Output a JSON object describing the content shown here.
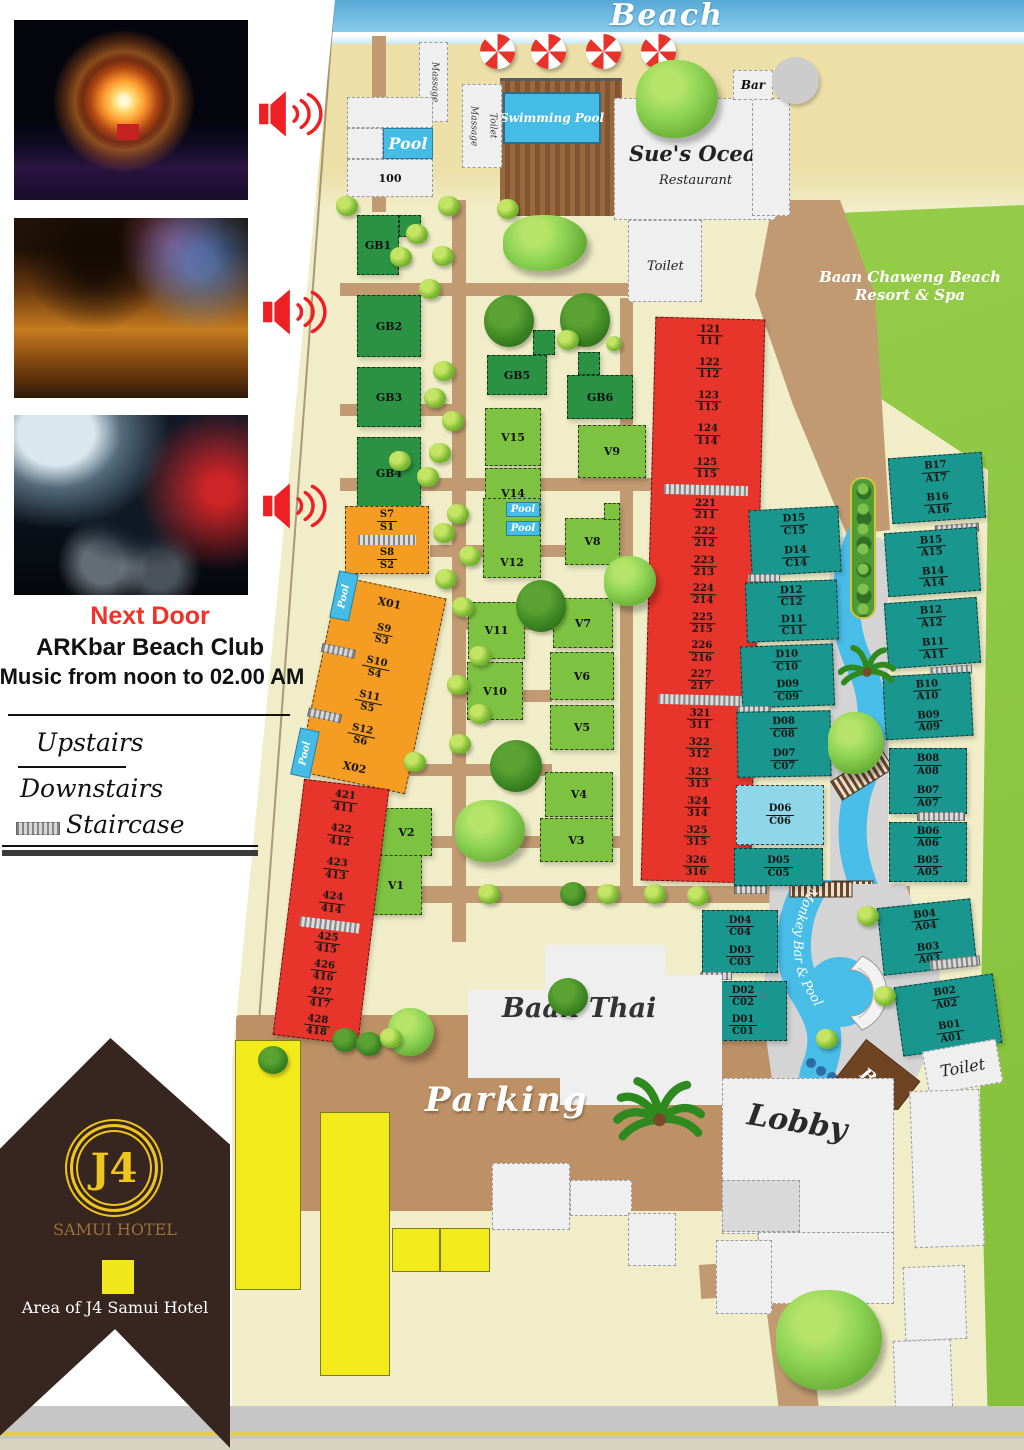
{
  "sidebar": {
    "next_door": "Next Door",
    "club_name": "ARKbar Beach Club",
    "music_hours": "Music from noon to 02.00 AM",
    "legend_upstairs": "Upstairs",
    "legend_downstairs": "Downstairs",
    "legend_staircase": "Staircase",
    "brand_mark": "J4",
    "brand_name": "SAMUI HOTEL",
    "area_label": "Area of J4 Samui Hotel",
    "accent_red": "#f03228",
    "brand_gold": "#eec51d",
    "area_swatch": "#f0e81c"
  },
  "map": {
    "beach": "Beach",
    "massage": "Massage",
    "massage_toilet": "Toilet",
    "pool": "Pool",
    "house_100": "100",
    "swimming_pool": "Swimming Pool",
    "restaurant_name": "Sue's Ocean",
    "restaurant_word": "Restaurant",
    "restaurant_toilet": "Toilet",
    "beach_bar": "Bar",
    "neighbor_line1": "Baan Chaweng Beach",
    "neighbor_line2": "Resort & Spa",
    "baan_thai": "Baan Thai",
    "parking": "Parking",
    "lobby": "Lobby",
    "monkey_pool": "Monkey Bar & Pool",
    "pool_bar": "Bar",
    "lobby_toilet": "Toilet",
    "gb": {
      "gb1": "GB1",
      "gb2": "GB2",
      "gb3": "GB3",
      "gb4": "GB4",
      "gb5": "GB5",
      "gb6": "GB6"
    },
    "v": {
      "v1": "V1",
      "v2": "V2",
      "v3": "V3",
      "v4": "V4",
      "v5": "V5",
      "v6": "V6",
      "v7": "V7",
      "v8": "V8",
      "v9": "V9",
      "v10": "V10",
      "v11": "V11",
      "v12": "V12",
      "v14": "V14",
      "v15": "V15"
    },
    "x": {
      "x01": "X01",
      "x02": "X02"
    },
    "colors": {
      "red": "#e8352b",
      "teal": "#19968e",
      "orange": "#f59d22",
      "light_green": "#7ec242",
      "dark_green": "#2b9143",
      "light_blue": "#8ed6e8",
      "pool_blue": "#45bce6",
      "grass": "#8bc53f",
      "path": "#c19a72",
      "yellow": "#f2ea1b"
    }
  },
  "rooms": {
    "east": [
      [
        [
          "121",
          "111"
        ],
        [
          "122",
          "112"
        ],
        [
          "123",
          "113"
        ],
        [
          "124",
          "114"
        ],
        [
          "125",
          "115"
        ]
      ],
      [
        [
          "221",
          "211"
        ],
        [
          "222",
          "212"
        ],
        [
          "223",
          "213"
        ],
        [
          "224",
          "214"
        ],
        [
          "225",
          "215"
        ],
        [
          "226",
          "216"
        ],
        [
          "227",
          "217"
        ]
      ],
      [
        [
          "321",
          "311"
        ],
        [
          "322",
          "312"
        ],
        [
          "323",
          "313"
        ],
        [
          "324",
          "314"
        ],
        [
          "325",
          "315"
        ],
        [
          "326",
          "316"
        ]
      ]
    ],
    "west": [
      [
        [
          "421",
          "411"
        ],
        [
          "422",
          "412"
        ],
        [
          "423",
          "413"
        ],
        [
          "424",
          "414"
        ]
      ],
      [
        [
          "425",
          "415"
        ],
        [
          "426",
          "416"
        ],
        [
          "427",
          "417"
        ],
        [
          "428",
          "418"
        ]
      ]
    ],
    "s_top_a": [
      [
        "S7",
        "S1"
      ]
    ],
    "s_top_b": [
      [
        "S8",
        "S2"
      ]
    ],
    "s_main": [
      [
        "S9",
        "S3"
      ],
      [
        "S10",
        "S4"
      ],
      [
        "S11",
        "S5"
      ],
      [
        "S12",
        "S6"
      ]
    ],
    "dc": [
      [
        [
          "D15",
          "C15"
        ],
        [
          "D14",
          "C14"
        ]
      ],
      [
        [
          "D12",
          "C12"
        ],
        [
          "D11",
          "C11"
        ]
      ],
      [
        [
          "D10",
          "C10"
        ],
        [
          "D09",
          "C09"
        ]
      ],
      [
        [
          "D08",
          "C08"
        ],
        [
          "D07",
          "C07"
        ]
      ]
    ],
    "dc_blue": [
      [
        "D06",
        "C06"
      ]
    ],
    "dc_05": [
      [
        "D05",
        "C05"
      ]
    ],
    "dc_low": [
      [
        [
          "D04",
          "C04"
        ],
        [
          "D03",
          "C03"
        ]
      ],
      [
        [
          "D02",
          "C02"
        ],
        [
          "D01",
          "C01"
        ]
      ]
    ],
    "ba": [
      [
        [
          "B17",
          "A17"
        ],
        [
          "B16",
          "A16"
        ]
      ],
      [
        [
          "B15",
          "A15"
        ],
        [
          "B14",
          "A14"
        ]
      ],
      [
        [
          "B12",
          "A12"
        ],
        [
          "B11",
          "A11"
        ]
      ],
      [
        [
          "B10",
          "A10"
        ],
        [
          "B09",
          "A09"
        ]
      ],
      [
        [
          "B08",
          "A08"
        ],
        [
          "B07",
          "A07"
        ]
      ],
      [
        [
          "B06",
          "A06"
        ],
        [
          "B05",
          "A05"
        ]
      ],
      [
        [
          "B04",
          "A04"
        ],
        [
          "B03",
          "A03"
        ]
      ],
      [
        [
          "B02",
          "A02"
        ],
        [
          "B01",
          "A01"
        ]
      ]
    ]
  }
}
